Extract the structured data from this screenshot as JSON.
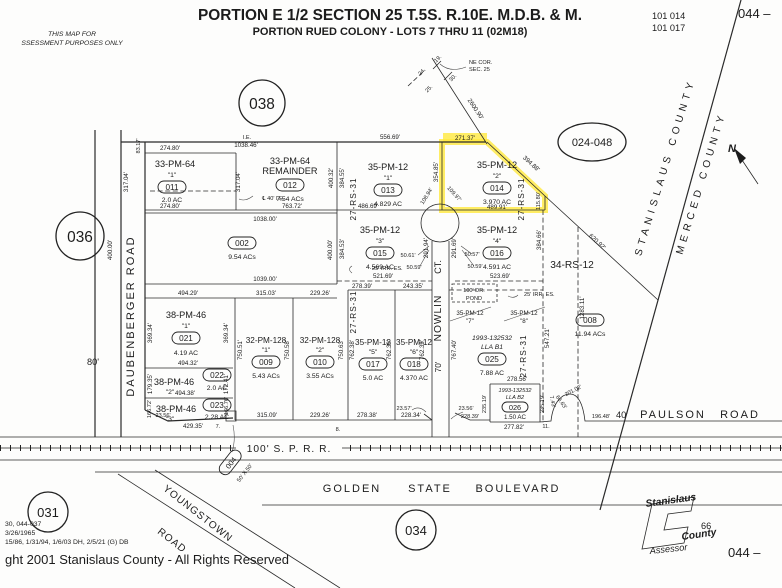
{
  "header": {
    "d1": "THIS MAP FOR",
    "d2": "SSESSMENT PURPOSES ONLY",
    "title": "PORTION E 1/2 SECTION 25 T.5S. R.10E. M.D.B. & M.",
    "subtitle": "PORTION RUED COLONY - LOTS 7 THRU 11 (02M18)",
    "r1": "101   014",
    "r2": "101   017",
    "page_tr": "044 –",
    "page_br": "044 –"
  },
  "refs": {
    "c038": "038",
    "c036": "036",
    "c031": "031",
    "c034": "034",
    "c024048": "024-048"
  },
  "corner": {
    "l1": "NE COR.",
    "l2": "SEC. 25",
    "s24": "24.",
    "s19": "19.",
    "s25": "25.",
    "s30": "30."
  },
  "county": {
    "stanislaus": "STANISLAUS COUNTY",
    "merced": "MERCED COUNTY",
    "north": "N"
  },
  "roads": {
    "daub": "DAUBENBERGER   ROAD",
    "daub_w": "80'",
    "nowlin": "NOWLIN",
    "nowlin_ct": "CT.",
    "nowlin_w": "70'",
    "sprr": "100' S. P. R. R.",
    "golden1": "GOLDEN",
    "golden2": "STATE",
    "golden3": "BOULEVARD",
    "paulson_w": "40'",
    "paulson1": "PAULSON",
    "paulson2": "ROAD",
    "young1": "YOUNGSTOWN",
    "young2": "ROAD"
  },
  "notes": {
    "ie": "I.E.",
    "cl40": "℄ 40' I.E.",
    "irr": "25' IRR. ES.",
    "pond1": "100' DR.",
    "pond2": "POND",
    "rs2731": "27-RS-31",
    "rs3412": "34-RS-12",
    "d83": "83.17'",
    "d2600": "2600.90'",
    "d620": "620.92'",
    "d1283": "1283.11'",
    "lot7": "7.",
    "lot8": "8.",
    "lot11": "11."
  },
  "parcels": {
    "p011": {
      "tract": "33-PM-64",
      "lot": "\"1\"",
      "num": "011",
      "area": "2.0 AC",
      "top": "274.80'",
      "bottom": "274.80'",
      "left": "317.04'",
      "right": "317.04'"
    },
    "p012": {
      "tract": "33-PM-64",
      "tract2": "REMAINDER",
      "num": "012",
      "area": "7.54 ACs",
      "top": "1038.46'",
      "bottom": "763.72'",
      "right": "400.32'"
    },
    "p013": {
      "tract": "35-PM-12",
      "lot": "\"1\"",
      "num": "013",
      "area": "4.829 AC",
      "top": "556.69'",
      "bottom": "486.69'",
      "left": "384.55'",
      "right": "354.85'"
    },
    "p014": {
      "tract": "35-PM-12",
      "lot": "\"2\"",
      "num": "014",
      "area": "3.970 AC",
      "top": "271.37'",
      "diag": "394.88'",
      "right": "115.80'",
      "bottom": "489.91'",
      "arc_l": "108.94'",
      "arc_r": "109.97'"
    },
    "p015": {
      "tract": "35-PM-12",
      "lot": "\"3\"",
      "num": "015",
      "area": "4.569 AC",
      "left": "384.53'",
      "right": "291.94'",
      "bottom": "521.69'",
      "arc1": "50.61'",
      "arc2": "50.59'"
    },
    "p016": {
      "tract": "35-PM-12",
      "lot": "\"4\"",
      "num": "016",
      "area": "4.591 AC",
      "left": "291.69'",
      "right": "384.66'",
      "bottom": "523.69'",
      "arc1": "50.57'",
      "arc2": "50.59'"
    },
    "p002": {
      "num": "002",
      "area": "9.54 ACs",
      "top": "1038.00'",
      "bottom": "1039.00'",
      "left": "400.00'",
      "right": "400.00'"
    },
    "p021": {
      "tract": "38-PM-46",
      "lot": "\"1\"",
      "num": "021",
      "area": "4.19 AC",
      "top": "494.29'",
      "bottom": "494.32'",
      "left": "369.34'",
      "right": "369.34'"
    },
    "p022": {
      "tract": "38-PM-46",
      "lot": "\"2\"",
      "num": "022",
      "area": "2.0 AC",
      "left": "179.35'",
      "right": "172.41'",
      "bottom": "494.38'"
    },
    "p023": {
      "tract": "38-PM-46",
      "lot": "\"3\"",
      "num": "023",
      "area": "2.28 AC",
      "left": "166.72'",
      "right": "166.76'",
      "bottom": "429.35'",
      "cut": "23.56'"
    },
    "p009": {
      "tract": "32-PM-128",
      "lot": "\"1\"",
      "num": "009",
      "area": "5.43 ACs",
      "top": "315.03'",
      "bottom": "315.09'",
      "left": "750.51'",
      "right": "750.58'"
    },
    "p010": {
      "tract": "32-PM-128",
      "lot": "\"2\"",
      "num": "010",
      "area": "3.55 ACs",
      "top": "229.26'",
      "bottom": "229.26'",
      "right": "750.63'",
      "right2": "762.38'"
    },
    "p017": {
      "tract": "35-PM-12",
      "lot": "\"5\"",
      "num": "017",
      "area": "5.0 AC",
      "top": "278.39'",
      "bottom": "278.38'",
      "right": "762.39'"
    },
    "p018": {
      "tract": "35-PM-12",
      "lot": "\"6\"",
      "num": "018",
      "area": "4.370 AC",
      "top": "243.35'",
      "bottom": "228.34'",
      "right": "762.39'",
      "cut": "23.57'"
    },
    "p025": {
      "ref": "1993-132532",
      "lla": "LLA B1",
      "num": "025",
      "area": "7.88 AC",
      "left": "767.40'",
      "right": "547.21'",
      "bottom": "278.56'",
      "struck_tract": "35-PM-12",
      "s7": "\"7\"",
      "s8": "\"8\"",
      "cut1": "23.56'",
      "cut2": "228.39'"
    },
    "p026": {
      "ref": "1993-132532",
      "lla": "LLA B2",
      "num": "026",
      "area": "1.50 AC",
      "left": "235.19'",
      "right": "235.19'",
      "bottom": "277.82'",
      "e1": "7.43'",
      "e2": "66.63'",
      "arc": "201.02'",
      "e3": "196.48'"
    },
    "p008": {
      "num": "008",
      "area": "11.94 ACs"
    },
    "p004": {
      "num": "004",
      "size": "50' X 50'"
    }
  },
  "stamp": {
    "l1": "Stanislaus",
    "l2": "County",
    "l3": "Assessor",
    "num": "66"
  },
  "footer": {
    "n1": "30, 044-037",
    "n2": "3/26/1965",
    "n3": "15/86, 1/31/94, 1/6/03 DH, 2/5/21 (G) DB",
    "copyright": "ght 2001 Stanislaus County - All Rights Reserved"
  }
}
